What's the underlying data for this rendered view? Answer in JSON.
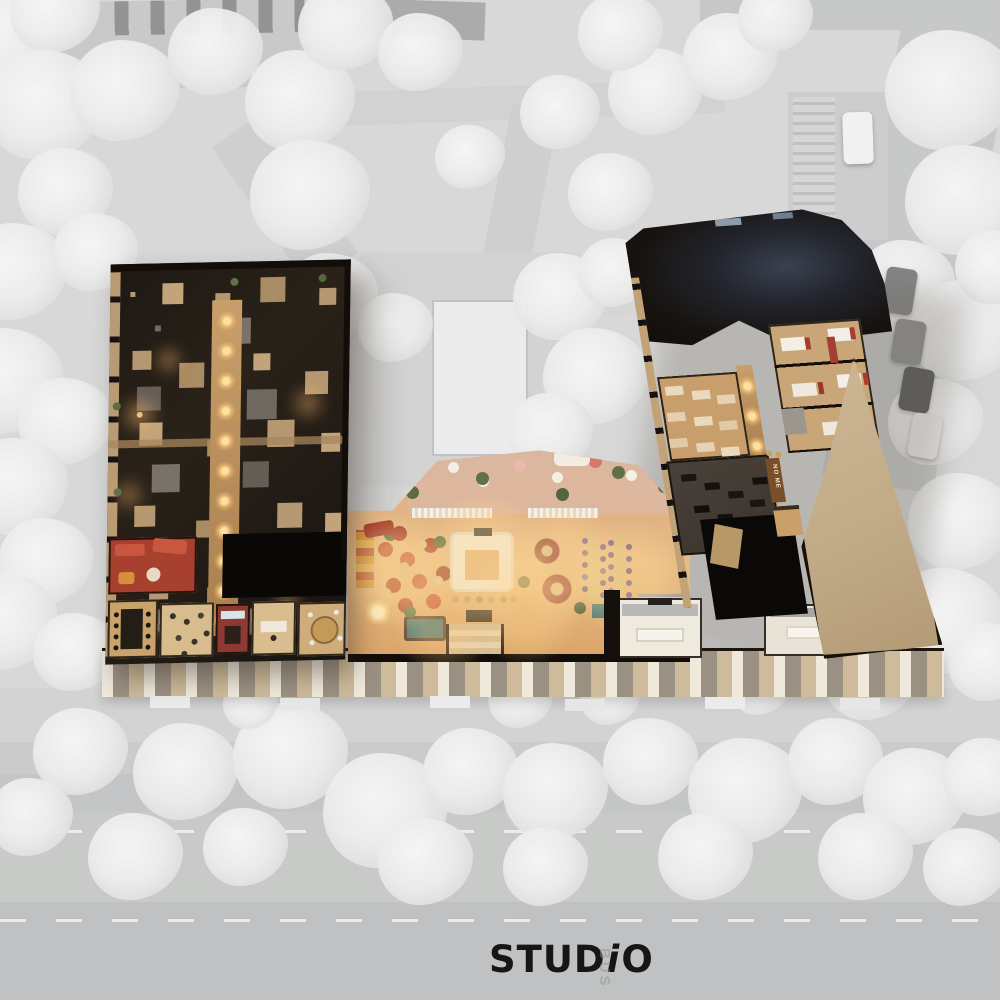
{
  "title": "Axonometric cutaway render of a residential building ground floor on a grayscale site plan",
  "logo": {
    "part1": "STUD",
    "part2": "i",
    "part3": "O",
    "color": "#161616"
  },
  "signs": {
    "gym_wall": "NO ME",
    "road_marking": "BUS"
  },
  "palette": {
    "site_bg": "#d8d8d8",
    "tree": "#ececec",
    "path": "#cfcfcf",
    "pad": "#d3d3d3",
    "court": "#ebebeb",
    "road": "#c3c5c6",
    "road_dark": "#bfc1c2",
    "marking": "#f0f0f0",
    "roof_dark": "#17130f",
    "wing_dark": "#1f1a14",
    "wall_tan": "#b99b74",
    "slab_gray": "#6f6860",
    "corridor": "#b8905c",
    "glow": "#ffd88a",
    "floor_warm": "#e2b379",
    "terrace": "#dcb8a2",
    "red": "#b2462e",
    "red_dark": "#8e3a30",
    "orange": "#d8913c",
    "purple": "#6f5f92",
    "island_white": "#f2ece0",
    "stainless": "#b9bab8",
    "teal": "#4f7d78",
    "wood": "#c79e6c",
    "gym_floor": "#433b33",
    "black_core": "#0b0908",
    "beige_room": "#c9b394",
    "facade_tan": "#cdbb9b",
    "plant": "#5c6b42",
    "bed_white": "#f4efe6",
    "bed_red": "#ab3b2f",
    "logo_color": "#161616"
  },
  "site": {
    "trees": [
      [
        0,
        40,
        110
      ],
      [
        55,
        15,
        90
      ],
      [
        45,
        110,
        120
      ],
      [
        125,
        95,
        110
      ],
      [
        215,
        55,
        95
      ],
      [
        300,
        105,
        110
      ],
      [
        345,
        30,
        95
      ],
      [
        420,
        55,
        85
      ],
      [
        65,
        195,
        95
      ],
      [
        15,
        275,
        105
      ],
      [
        95,
        255,
        85
      ],
      [
        5,
        385,
        115
      ],
      [
        65,
        425,
        95
      ],
      [
        15,
        490,
        105
      ],
      [
        45,
        565,
        95
      ],
      [
        5,
        625,
        105
      ],
      [
        75,
        655,
        85
      ],
      [
        310,
        200,
        120
      ],
      [
        330,
        300,
        95
      ],
      [
        395,
        330,
        75
      ],
      [
        470,
        160,
        70
      ],
      [
        560,
        115,
        80
      ],
      [
        610,
        195,
        85
      ],
      [
        655,
        95,
        95
      ],
      [
        620,
        35,
        85
      ],
      [
        730,
        60,
        95
      ],
      [
        775,
        20,
        75
      ],
      [
        560,
        300,
        95
      ],
      [
        595,
        380,
        105
      ],
      [
        550,
        435,
        85
      ],
      [
        615,
        275,
        75
      ],
      [
        950,
        95,
        130
      ],
      [
        965,
        205,
        120
      ],
      [
        905,
        290,
        100
      ],
      [
        965,
        335,
        110
      ],
      [
        935,
        425,
        95
      ],
      [
        995,
        270,
        80
      ],
      [
        960,
        525,
        105
      ],
      [
        945,
        625,
        115
      ],
      [
        870,
        680,
        95
      ],
      [
        990,
        665,
        85
      ],
      [
        80,
        755,
        95
      ],
      [
        185,
        775,
        105
      ],
      [
        290,
        760,
        115
      ],
      [
        385,
        815,
        125
      ],
      [
        470,
        775,
        95
      ],
      [
        555,
        795,
        105
      ],
      [
        650,
        765,
        95
      ],
      [
        745,
        795,
        115
      ],
      [
        835,
        765,
        95
      ],
      [
        915,
        800,
        105
      ],
      [
        985,
        780,
        85
      ],
      [
        30,
        820,
        85
      ],
      [
        135,
        860,
        95
      ],
      [
        245,
        850,
        85
      ],
      [
        425,
        865,
        95
      ],
      [
        545,
        870,
        85
      ],
      [
        705,
        860,
        95
      ],
      [
        865,
        860,
        95
      ],
      [
        965,
        870,
        85
      ],
      [
        520,
        700,
        65
      ],
      [
        250,
        705,
        55
      ],
      [
        610,
        700,
        60
      ],
      [
        760,
        690,
        60
      ]
    ],
    "cars": [
      {
        "x": 884,
        "y": 268,
        "w": 31,
        "h": 46,
        "color": "#848484",
        "rot": 9
      },
      {
        "x": 893,
        "y": 320,
        "w": 31,
        "h": 44,
        "color": "#8f8f8f",
        "rot": 9
      },
      {
        "x": 901,
        "y": 368,
        "w": 31,
        "h": 44,
        "color": "#585858",
        "rot": 10
      },
      {
        "x": 910,
        "y": 414,
        "w": 30,
        "h": 44,
        "color": "#ededed",
        "rot": 10
      },
      {
        "x": 843,
        "y": 112,
        "w": 30,
        "h": 52,
        "color": "#f1f1f1",
        "rot": -2
      }
    ]
  }
}
